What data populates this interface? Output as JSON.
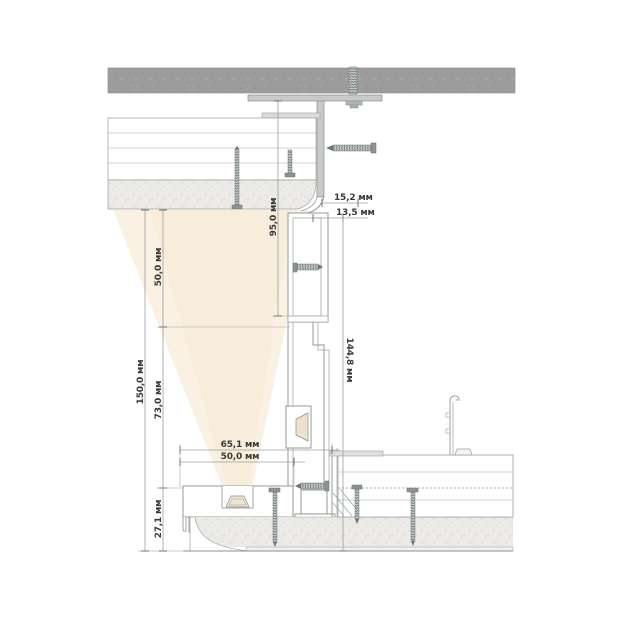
{
  "drawing": {
    "type": "section-detail",
    "unit_suffix": "мм",
    "dimensions": {
      "shadow_gap_width": "15,2 мм",
      "profile_flange_width": "13,5 мм",
      "step_height": "144,8 мм",
      "hanger_height": "95,0 мм",
      "left_total_height": "150,0 мм",
      "left_upper_segment": "50,0 мм",
      "left_middle_segment": "73,0 мм",
      "left_lower_segment": "27,1 мм",
      "bottom_outer_width": "65,1 мм",
      "bottom_inner_width": "50,0 мм"
    },
    "colors": {
      "concrete_slab": "#9b9b9b",
      "plaster_finish": "#eae9e6",
      "metal_outline": "#8a9090",
      "light_cone": "#f9efdc",
      "dimension_text": "#3a3a3a"
    }
  }
}
